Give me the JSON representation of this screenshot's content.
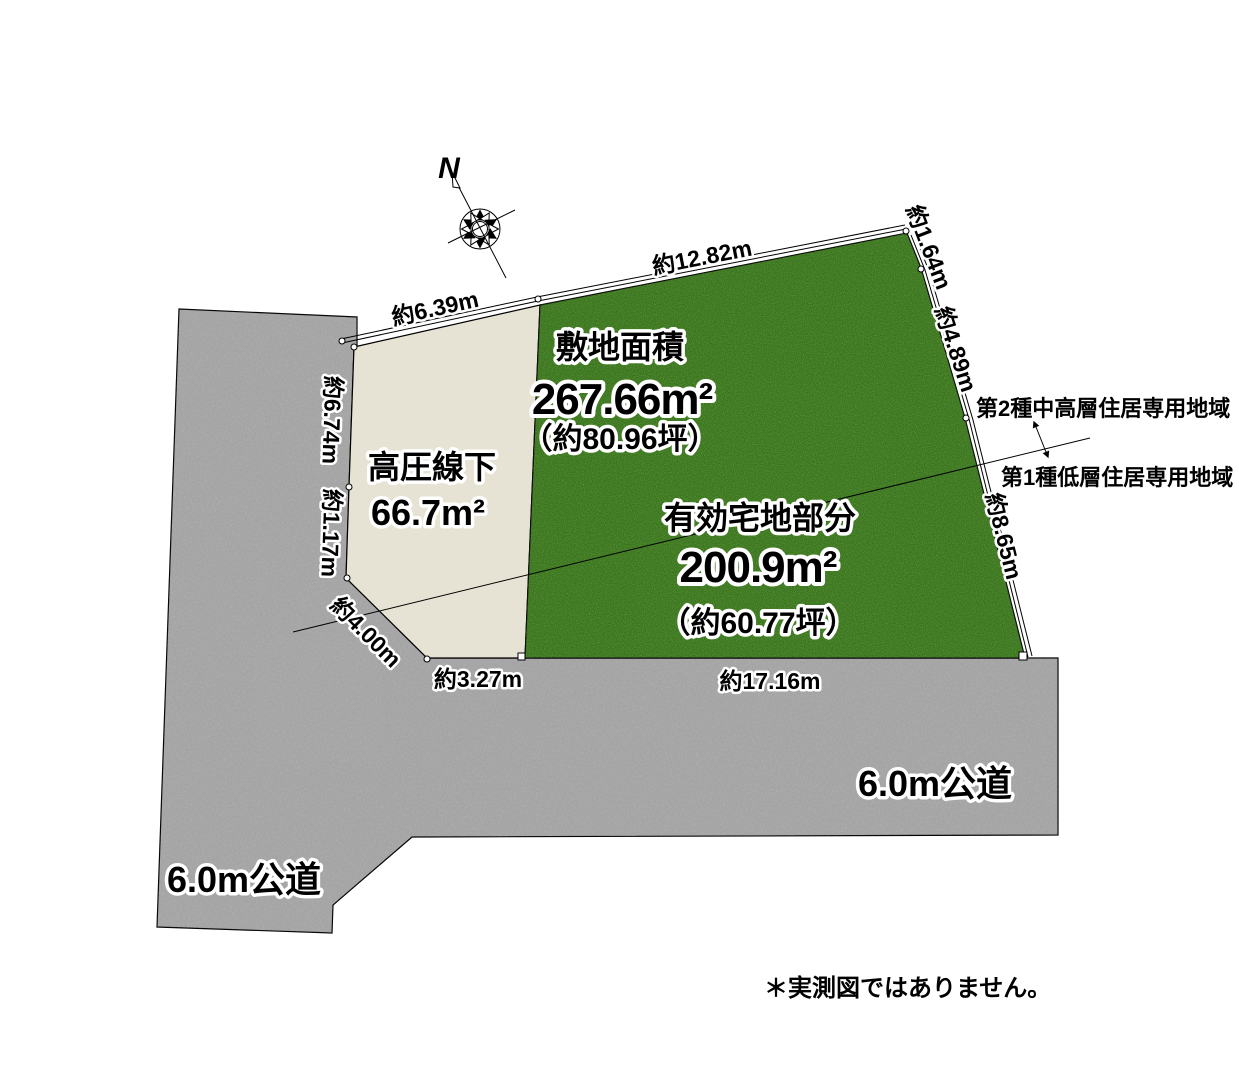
{
  "diagram": {
    "north_label": "N",
    "note": "＊実測図ではありません。",
    "site": {
      "label": "敷地面積",
      "area": "267.66m²",
      "area_tsubo": "（約80.96坪）"
    },
    "effective_lot": {
      "label": "有効宅地部分",
      "area": "200.9m²",
      "area_tsubo": "（約60.77坪）"
    },
    "high_voltage": {
      "label": "高圧線下",
      "area": "66.7m²"
    },
    "roads": {
      "bottom_label": "6.0m公道",
      "left_label": "6.0m公道"
    },
    "zoning": {
      "upper": "第2種中高層住居専用地域",
      "lower": "第1種低層住居専用地域"
    },
    "dimensions": {
      "top_left": "約6.39m",
      "top": "約12.82m",
      "right_top": "約1.64m",
      "right_mid": "約4.89m",
      "right_bottom": "約8.65m",
      "left_upper": "約6.74m",
      "left_lower": "約1.17m",
      "corner_diagonal": "約4.00m",
      "bottom_left": "約3.27m",
      "bottom_right": "約17.16m"
    },
    "colors": {
      "grass": "#336f17",
      "road": "#a6a6a6",
      "lot": "#e7e3d4",
      "background": "#ffffff"
    }
  }
}
